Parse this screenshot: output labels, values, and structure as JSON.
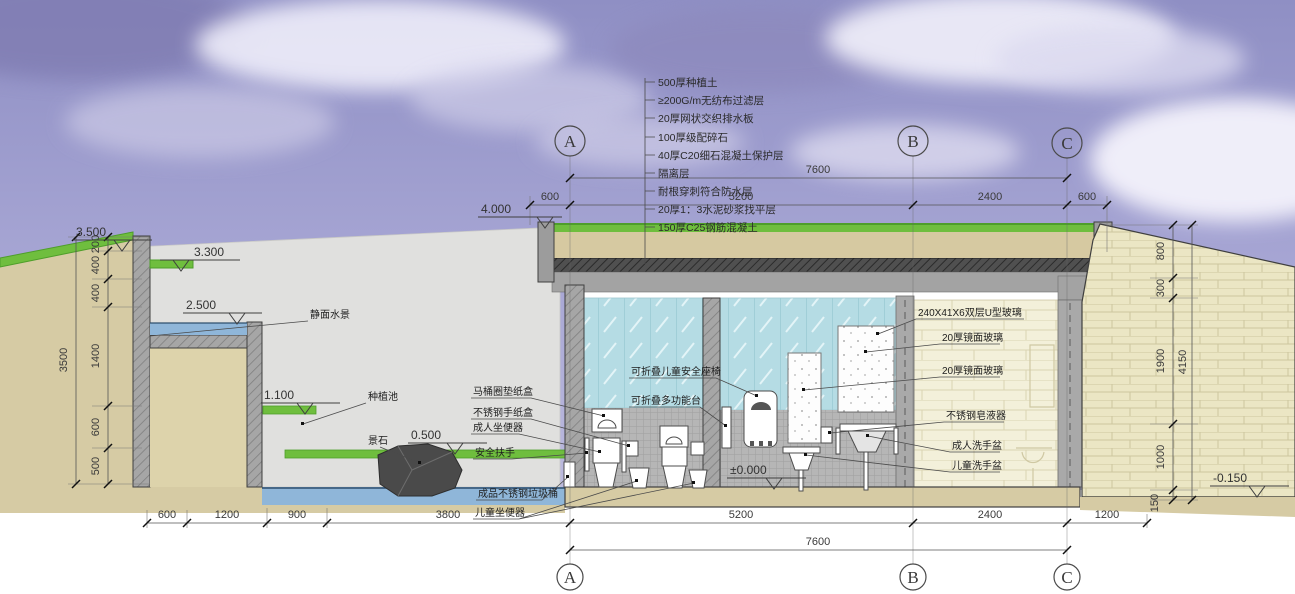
{
  "drawing": {
    "title_hint": "公共卫生间剖面图",
    "roof_layers": [
      "500厚种植土",
      "≥200G/m无纺布过滤层",
      "20厚网状交织排水板",
      "100厚级配碎石",
      "40厚C20细石混凝土保护层",
      "隔离层",
      "耐根穿刺符合防水层",
      "20厚1：3水泥砂浆找平层",
      "150厚C25钢筋混凝土"
    ],
    "grid_axes": [
      "A",
      "B",
      "C"
    ],
    "levels": {
      "roof_parapet": "4.000",
      "wall_top": "3.500",
      "planter_top": "3.300",
      "water_feature": "2.500",
      "planter": "1.100",
      "ground": "0.500",
      "floor": "±0.000",
      "outside_ground": "-0.150"
    },
    "annotations_left": {
      "water": "静面水景",
      "planter": "种植池",
      "stone": "景石",
      "seat_paper_box": "马桶圈垫纸盒",
      "paper_box": "不锈钢手纸盒",
      "adult_toilet": "成人坐便器",
      "grab_bar": "安全扶手",
      "trash_bin": "成品不锈钢垃圾桶",
      "child_toilet": "儿童坐便器"
    },
    "annotations_center": {
      "child_seat": "可折叠儿童安全座椅",
      "folding_table": "可折叠多功能台"
    },
    "annotations_right": {
      "u_glass": "240X41X6双层U型玻璃",
      "mirror1": "20厚镜面玻璃",
      "mirror2": "20厚镜面玻璃",
      "soap": "不锈钢皂液器",
      "adult_basin": "成人洗手盆",
      "child_basin": "儿童洗手盆"
    },
    "dims": {
      "top": [
        "600",
        "5200",
        "2400",
        "600"
      ],
      "top_total": "7600",
      "bottom": [
        "600",
        "1200",
        "900",
        "3800",
        "5200",
        "2400",
        "1200"
      ],
      "bottom_total": "7600",
      "left_chain": [
        "200",
        "400",
        "400",
        "1400",
        "600",
        "500"
      ],
      "left_total": "3500",
      "right_chain": [
        "800",
        "300",
        "1900",
        "1000",
        "150"
      ],
      "right_total": "4150"
    },
    "palette": {
      "sky": "#9a9ace",
      "ground": "#d6cba4",
      "grass": "#6fbe3e",
      "water": "#8fb6d9",
      "glass": "#b5dce4",
      "stone": "#ebe6c4",
      "concrete": "#a6a6a6"
    }
  }
}
